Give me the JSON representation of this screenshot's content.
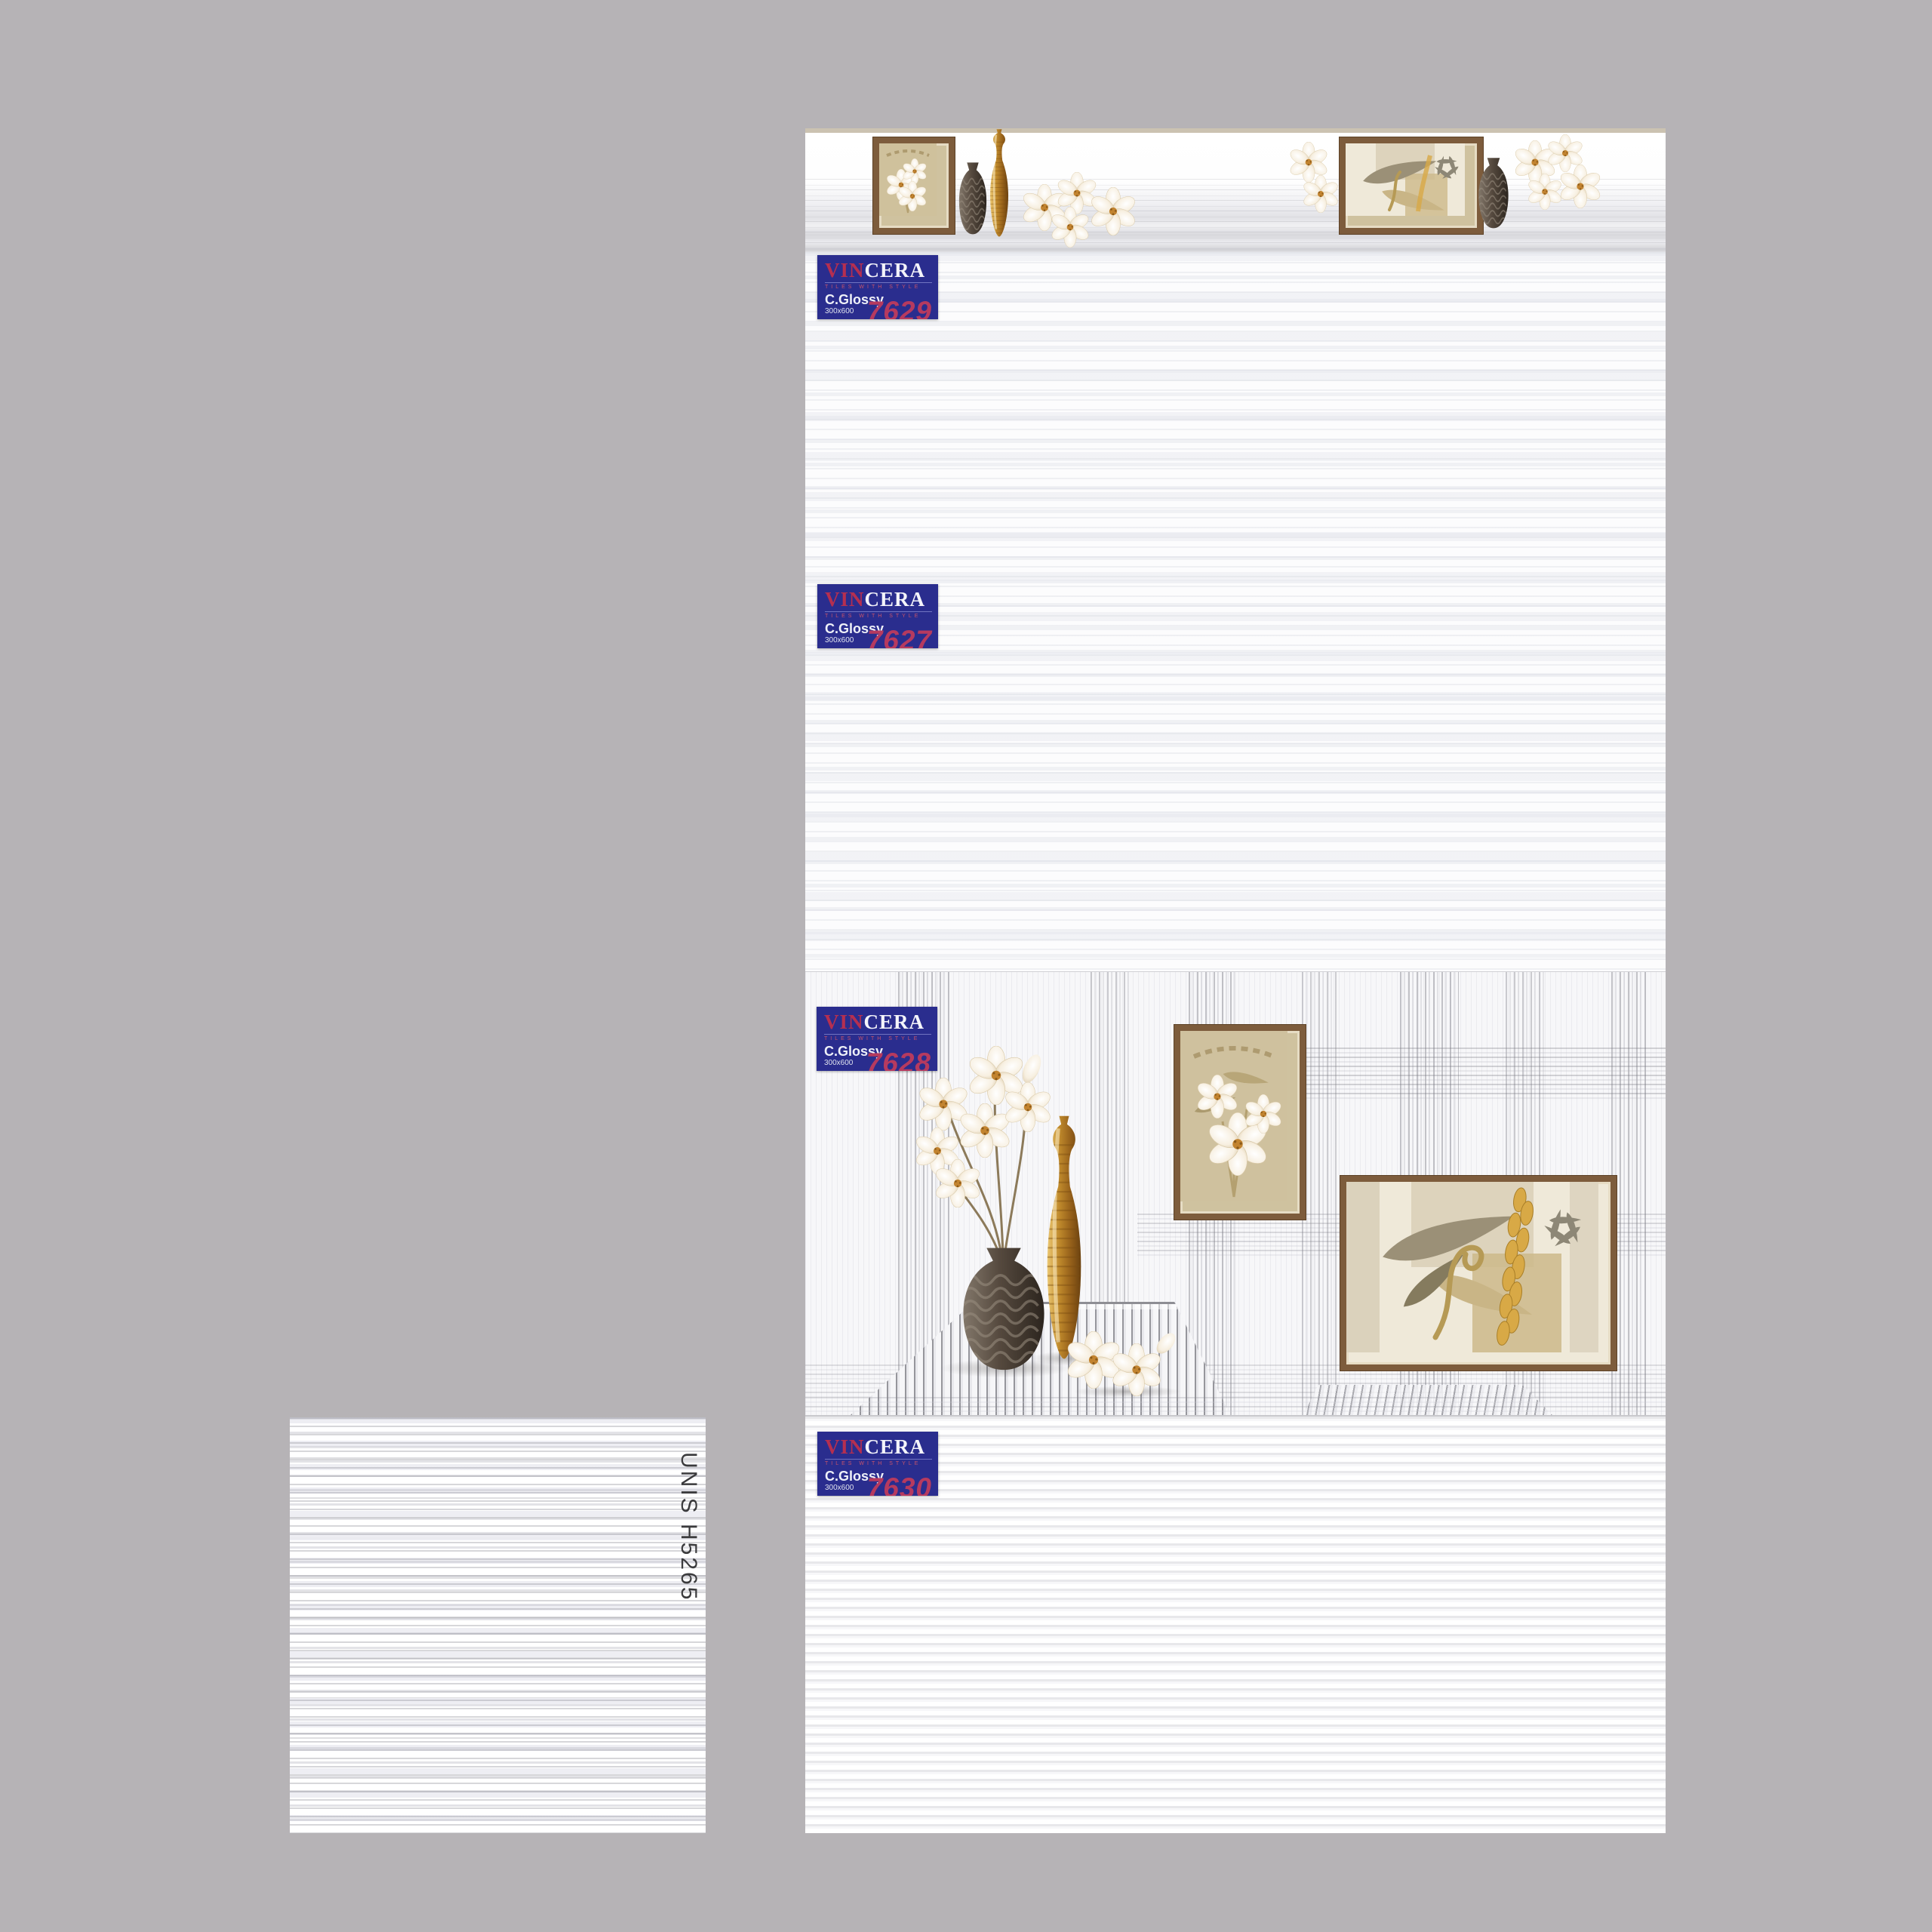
{
  "page": {
    "background_color": "#b6b3b6",
    "panel_color": "#fbfbfc"
  },
  "brand": {
    "vin": "VIN",
    "cera": "CERA",
    "tagline": "TILES WITH STYLE",
    "finish": "C.Glossy",
    "size": "300x600",
    "logo_bg_color": "#2a2d8e",
    "accent_color": "#b63a5f"
  },
  "tiles": [
    {
      "code": "7629"
    },
    {
      "code": "7627"
    },
    {
      "code": "7628"
    },
    {
      "code": "7630"
    }
  ],
  "swatch": {
    "label": "UNIS H5265"
  },
  "decor_colors": {
    "frame_brown": "#7d5c3c",
    "gold": "#c08a2c",
    "dark_vase": "#55493e"
  }
}
